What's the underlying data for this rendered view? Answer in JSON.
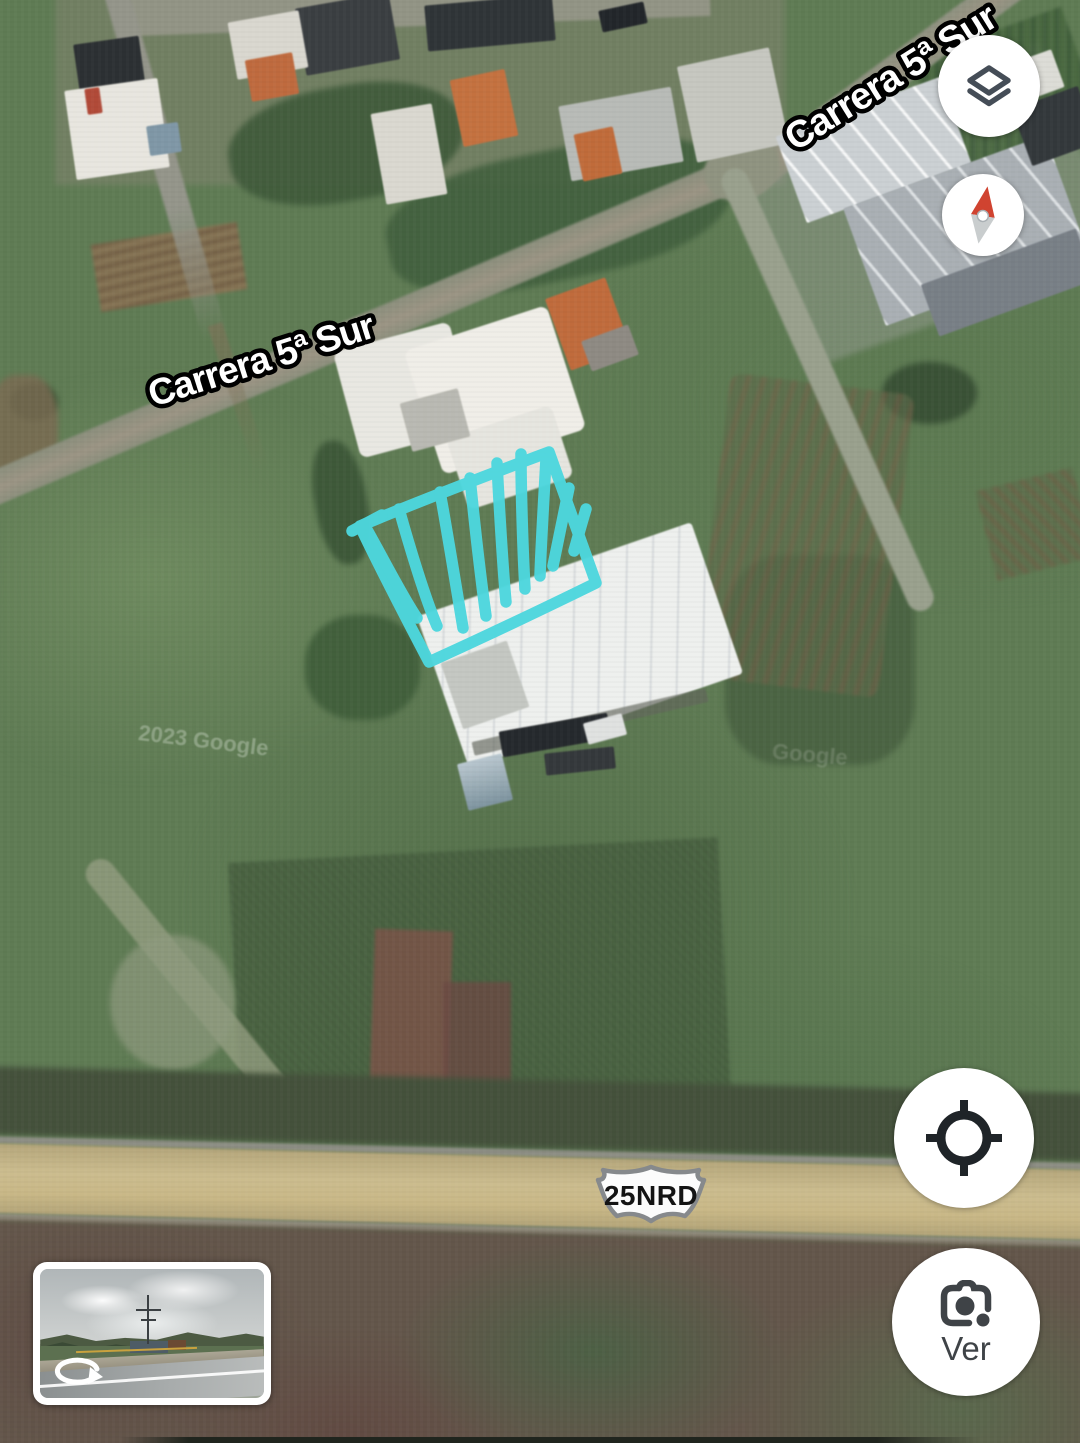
{
  "map": {
    "street_labels": [
      {
        "text": "Carrera 5ª Sur"
      },
      {
        "text": "Carrera 5ª Sur"
      }
    ],
    "route_shield": {
      "text": "25NRD"
    },
    "watermarks": [
      {
        "text": "2023 Google"
      },
      {
        "text": "Google"
      }
    ],
    "annotation": {
      "type": "hand-drawn hatched parallelogram",
      "color": "#4DD7DE"
    }
  },
  "controls": {
    "layers": {
      "icon": "layers-icon"
    },
    "compass": {
      "icon": "compass-icon"
    },
    "my_location": {
      "icon": "my-location-crosshair-icon"
    },
    "street_view_button": {
      "label": "Ver",
      "icon": "lens-camera-icon"
    },
    "street_view_thumbnail": {
      "icon": "rotate-view-icon"
    }
  },
  "colors": {
    "annotation_cyan": "#4DD7DE",
    "compass_north_red": "#d04330",
    "icon_gray": "#3f4347",
    "highway_tan": "#c9b887"
  }
}
